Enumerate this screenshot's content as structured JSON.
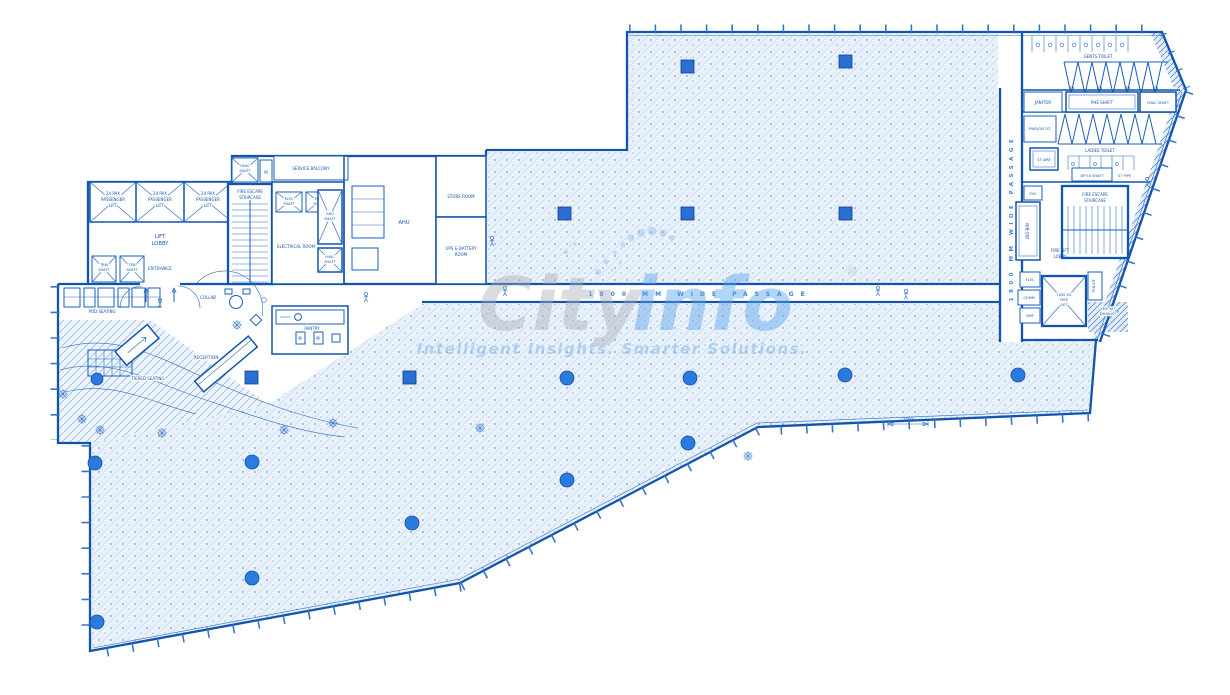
{
  "labels": {
    "lift": [
      "24 PAX",
      "PASSENGER",
      "LIFT"
    ],
    "lift_lobby": [
      "LIFT",
      "LOBBY"
    ],
    "trw_shaft": [
      "TRW",
      "SHAFT"
    ],
    "ten_shaft": [
      "TEN",
      "SHAFT"
    ],
    "entrance": "ENTRANCE",
    "fire_escape": [
      "FIRE ESCAPE",
      "STAIRCASE"
    ],
    "hvac_shaft2": [
      "HVAC",
      "SHAFT"
    ],
    "m_box": "M",
    "service_balcony": "SERVICE BALCONY",
    "elec_shaft": [
      "ELEC",
      "SHAFT"
    ],
    "electrical_room": "ELECTRICAL ROOM",
    "ahu_shaft": [
      "AHU",
      "SHAFT"
    ],
    "ahu": "AHU",
    "store_room": "STORE ROOM",
    "ups_room": [
      "UPS & BATTERY",
      "ROOM"
    ],
    "pantry": "PANTRY",
    "pod_seating": "POD SEATING",
    "tiered_seating": "TIERED SEATING",
    "collab": "COLLAB",
    "reception": "RECEPTION",
    "gents_toilet": "GENTS TOILET",
    "janitor": "JANITOR",
    "phe_shaft": "PHE SHAFT",
    "hvac_shaft_r": "HVAC SHAFT",
    "pwd_toilet": "PWD/GN TLT.",
    "ladies_toilet": "LADIES TOILET",
    "st_aire": "ST AIRE",
    "dp_ex_shaft": "DP EX SHAFT",
    "st_pipe": "ST PIPE",
    "fhc": "FHC",
    "bio_bin": "BIO-BIN",
    "fire_lift_lobby": [
      "FIRE LIFT",
      "LOBBY"
    ],
    "fire_lift": [
      "1000 KG",
      "FIRE",
      "LIFT"
    ],
    "elec_box": "ELEC",
    "comm_box": "COMM",
    "emp_box": "EMP",
    "ten_kit": "TEN KIT",
    "ten_kit_exhaust": [
      "TEN. KIT",
      "EXHAUST"
    ],
    "passage": "1800 MM WIDE PASSAGE",
    "dim_1500": "1500"
  },
  "watermark": {
    "brand_gray": "City",
    "brand_blue": "info",
    "registered": "®",
    "tagline": "Intelligent Insights. Smarter Solutions."
  },
  "colors": {
    "wall": "#1254ac",
    "accent": "#2d6fc7",
    "column": "#2b74d8",
    "hatch_dot": "#6f9fd8",
    "watermark_gray": "#a6abb3",
    "watermark_blue": "#58a2ea"
  }
}
